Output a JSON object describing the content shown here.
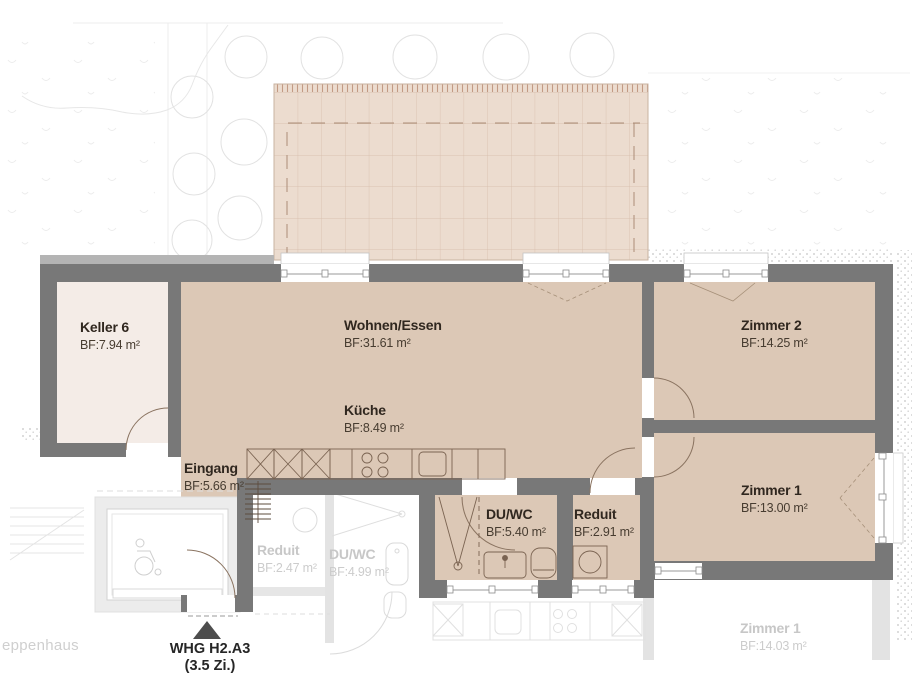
{
  "title": "Floor plan WHG H2.A3",
  "marker": {
    "line1": "WHG H2.A3",
    "line2": "(3.5 Zi.)"
  },
  "rooms": [
    {
      "key": "keller",
      "name": "Keller 6",
      "area": "BF:7.94 m²"
    },
    {
      "key": "wohnen-essen",
      "name": "Wohnen/Essen",
      "area": "BF:31.61 m²"
    },
    {
      "key": "kueche",
      "name": "Küche",
      "area": "BF:8.49 m²"
    },
    {
      "key": "zimmer2",
      "name": "Zimmer 2",
      "area": "BF:14.25 m²"
    },
    {
      "key": "zimmer1",
      "name": "Zimmer 1",
      "area": "BF:13.00 m²"
    },
    {
      "key": "eingang",
      "name": "Eingang",
      "area": "BF:5.66 m²"
    },
    {
      "key": "duwc",
      "name": "DU/WC",
      "area": "BF:5.40 m²"
    },
    {
      "key": "reduit",
      "name": "Reduit",
      "area": "BF:2.91 m²"
    }
  ],
  "adjacent_rooms": [
    {
      "key": "reduit-nachbar",
      "name": "Reduit",
      "area": "BF:2.47 m²"
    },
    {
      "key": "duwc-nachbar",
      "name": "DU/WC",
      "area": "BF:4.99 m²"
    },
    {
      "key": "zimmer1-unten",
      "name": "Zimmer 1",
      "area": "BF:14.03 m²"
    }
  ],
  "stairwell_label": "eppenhaus",
  "colors": {
    "wall": "#787878",
    "apartment_floor": "#dcc8b6",
    "keller_floor": "#f4ece7",
    "terrace": "#ecdccf",
    "terrace_grid": "#cbab97",
    "fixture_line": "#7a6351",
    "faded_line": "#dcdcdc",
    "faded_text": "#c9c9c9",
    "label_text": "#30271f"
  }
}
